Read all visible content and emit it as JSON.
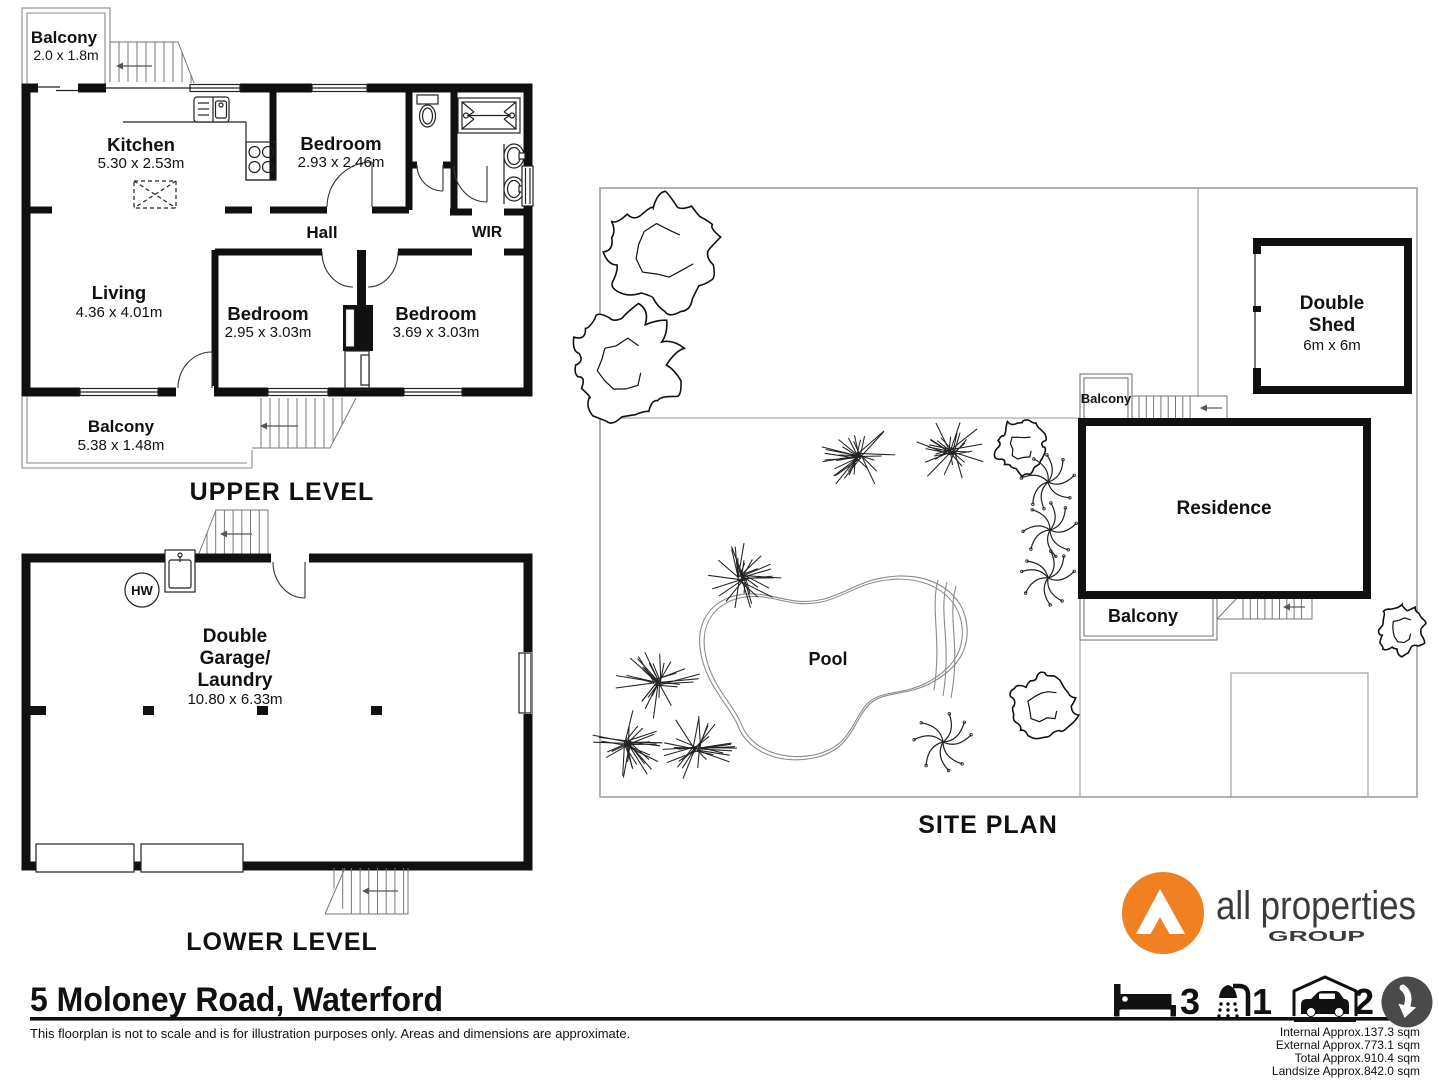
{
  "upper": {
    "heading": "UPPER LEVEL",
    "balcony_top": {
      "name": "Balcony",
      "dims": "2.0 x 1.8m"
    },
    "kitchen": {
      "name": "Kitchen",
      "dims": "5.30 x 2.53m"
    },
    "bedroom1": {
      "name": "Bedroom",
      "dims": "2.93 x 2.46m"
    },
    "hall": {
      "name": "Hall"
    },
    "wir": {
      "name": "WIR"
    },
    "living": {
      "name": "Living",
      "dims": "4.36 x 4.01m"
    },
    "bedroom2": {
      "name": "Bedroom",
      "dims": "2.95 x 3.03m"
    },
    "bedroom3": {
      "name": "Bedroom",
      "dims": "3.69 x 3.03m"
    },
    "balcony_main": {
      "name": "Balcony",
      "dims": "5.38 x 1.48m"
    }
  },
  "lower": {
    "heading": "LOWER LEVEL",
    "garage": {
      "line1": "Double",
      "line2": "Garage/",
      "line3": "Laundry",
      "dims": "10.80 x 6.33m"
    },
    "hw": {
      "label": "HW"
    }
  },
  "site": {
    "heading": "SITE PLAN",
    "shed": {
      "line1": "Double",
      "line2": "Shed",
      "dims": "6m x 6m"
    },
    "residence": {
      "name": "Residence"
    },
    "balcony_upper": {
      "name": "Balcony"
    },
    "balcony_lower": {
      "name": "Balcony"
    },
    "pool": {
      "name": "Pool"
    }
  },
  "stats": {
    "beds": "3",
    "baths": "1",
    "cars": "2"
  },
  "footer": {
    "address": "5 Moloney Road, Waterford",
    "disclaimer": "This floorplan is not to scale and is for illustration purposes only. Areas and dimensions are approximate.",
    "areas": [
      "Internal Approx.137.3 sqm",
      "External Approx.773.1 sqm",
      "Total Approx.910.4 sqm",
      "Landsize Approx.842.0 sqm"
    ]
  },
  "brand": {
    "name": "all properties",
    "group": "GROUP",
    "orange": "#F08021",
    "text_color": "#3B3B3B",
    "compass_color": "#4A4A4A"
  }
}
